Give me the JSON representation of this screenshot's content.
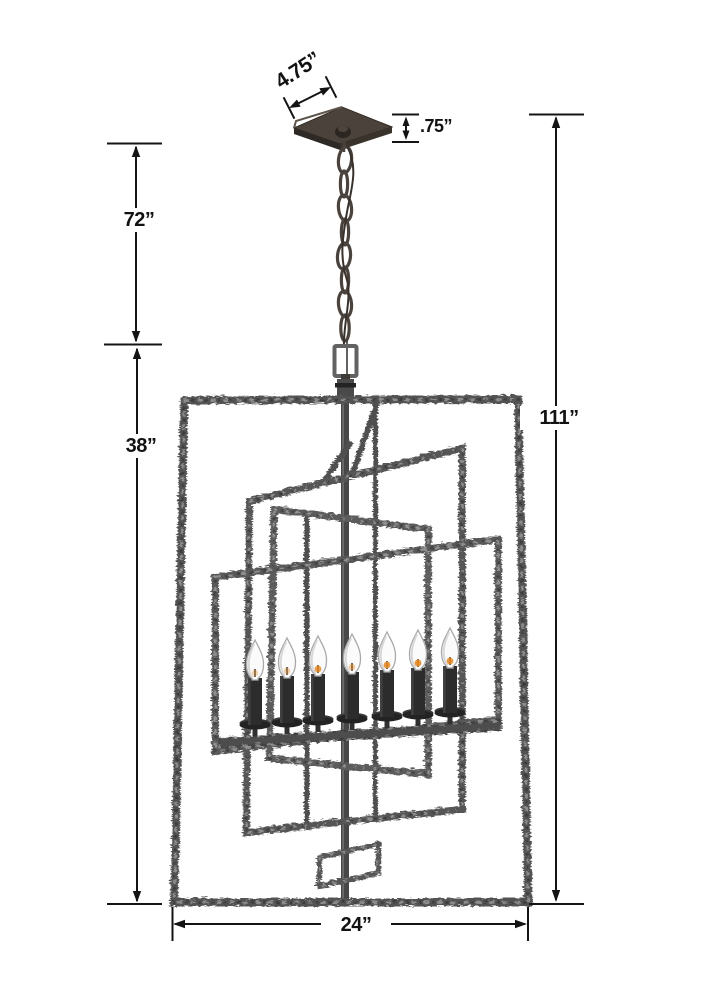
{
  "diagram": {
    "kind": "product-dimension-diagram",
    "labels": {
      "canopy_width": "4.75”",
      "canopy_drop": ".75”",
      "chain_length": "72”",
      "cage_height": "38”",
      "overall_height": "111”",
      "cage_width": "24”"
    },
    "colors": {
      "dimension_ink": "#141414",
      "metal_dark": "#3c3c3c",
      "metal_mid": "#585858",
      "metal_light": "#909090",
      "canopy": "#4a423b",
      "candle_black": "#2c2c2c",
      "bulb_white": "#fbfbfb",
      "flame_glow": "#e8871e"
    }
  }
}
